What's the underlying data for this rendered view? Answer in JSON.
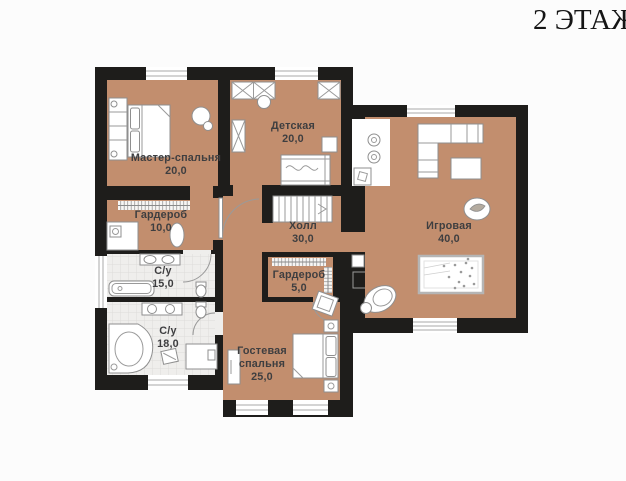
{
  "page": {
    "title": "2 ЭТАЖ"
  },
  "palette": {
    "floor": "#c28e6e",
    "wall": "#1e1d1b",
    "background": "#fcfcfc",
    "tile_floor": "#efeeec",
    "label_text": "#3e3e40"
  },
  "rooms": {
    "master": {
      "name": "Мастер-спальня",
      "area": "20,0"
    },
    "detskaya": {
      "name": "Детская",
      "area": "20,0"
    },
    "wardrobe10": {
      "name": "Гардероб",
      "area": "10,0"
    },
    "hall": {
      "name": "Холл",
      "area": "30,0"
    },
    "playroom": {
      "name": "Игровая",
      "area": "40,0"
    },
    "su15": {
      "name": "С/у",
      "area": "15,0"
    },
    "su18": {
      "name": "С/у",
      "area": "18,0"
    },
    "wardrobe5": {
      "name": "Гардероб",
      "area": "5,0"
    },
    "guest": {
      "name_line1": "Гостевая",
      "name_line2": "спальня",
      "area": "25,0"
    }
  }
}
